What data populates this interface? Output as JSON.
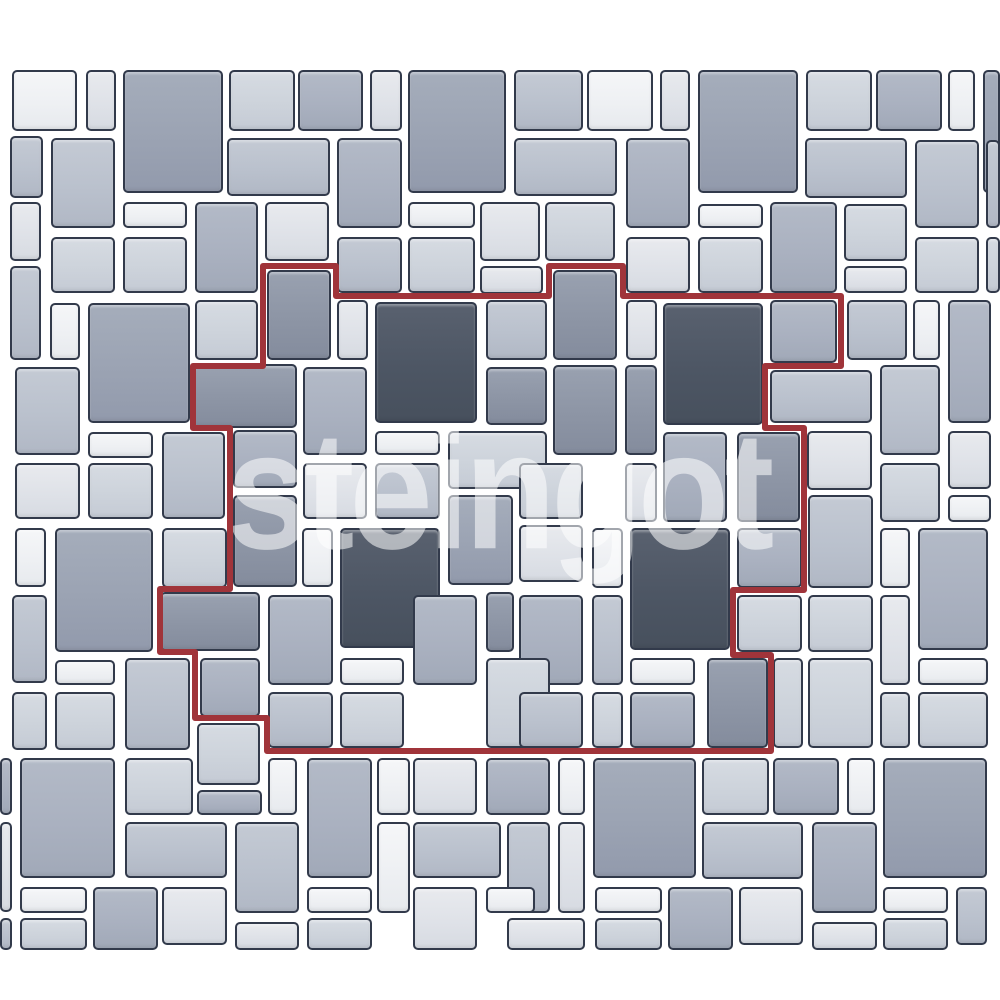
{
  "canvas": {
    "width": 1000,
    "height": 1000,
    "background": "#ffffff"
  },
  "watermark": {
    "text": "steingot",
    "color": "rgba(255,255,255,0.55)"
  },
  "module_outline": {
    "color": "#a0343a",
    "stroke_width": 6,
    "path": "M263,266 H336 V296 H549 V266 H623 V296 H841 V366 H765 V428 H804 V590 H733 V655 H771 V751 H267 V718 H195 V652 H160 V589 H230 V428 H193 V366 H263 Z"
  },
  "palette": {
    "c0": {
      "top": "#f5f6f8",
      "base": "#eef0f3",
      "bottom": "#e7eaee"
    },
    "c1": {
      "top": "#e8eaee",
      "base": "#dfe2e8",
      "bottom": "#d7dbe2"
    },
    "c2": {
      "top": "#d6dbe2",
      "base": "#cdd3db",
      "bottom": "#c5cbd5"
    },
    "c3": {
      "top": "#c4cad4",
      "base": "#bac1cd",
      "bottom": "#b1b8c5"
    },
    "c4": {
      "top": "#b3bac7",
      "base": "#aab1c0",
      "bottom": "#a1a9b8"
    },
    "c5": {
      "top": "#a5adbb",
      "base": "#9ba3b3",
      "bottom": "#929aac"
    },
    "c6": {
      "top": "#99a1b0",
      "base": "#8d95a5",
      "bottom": "#848c9d"
    },
    "c7": {
      "top": "#59616f",
      "base": "#4d5664",
      "bottom": "#47505d"
    }
  },
  "tile_border_color": "#323a4b",
  "tiles": [
    [
      12,
      70,
      65,
      61,
      "c0"
    ],
    [
      86,
      70,
      30,
      61,
      "c1"
    ],
    [
      123,
      70,
      100,
      123,
      "c5"
    ],
    [
      229,
      70,
      66,
      61,
      "c2"
    ],
    [
      298,
      70,
      65,
      61,
      "c4"
    ],
    [
      370,
      70,
      32,
      61,
      "c1"
    ],
    [
      408,
      70,
      98,
      123,
      "c5"
    ],
    [
      514,
      70,
      69,
      61,
      "c3"
    ],
    [
      587,
      70,
      66,
      61,
      "c0"
    ],
    [
      660,
      70,
      30,
      61,
      "c1"
    ],
    [
      698,
      70,
      100,
      123,
      "c5"
    ],
    [
      806,
      70,
      66,
      61,
      "c2"
    ],
    [
      876,
      70,
      66,
      61,
      "c4"
    ],
    [
      948,
      70,
      27,
      61,
      "c0"
    ],
    [
      983,
      70,
      17,
      123,
      "c5"
    ],
    [
      10,
      136,
      33,
      62,
      "c3"
    ],
    [
      51,
      138,
      64,
      90,
      "c3"
    ],
    [
      227,
      138,
      103,
      58,
      "c3"
    ],
    [
      337,
      138,
      65,
      90,
      "c4"
    ],
    [
      514,
      138,
      103,
      58,
      "c3"
    ],
    [
      626,
      138,
      64,
      90,
      "c4"
    ],
    [
      805,
      138,
      102,
      60,
      "c3"
    ],
    [
      915,
      140,
      64,
      88,
      "c3"
    ],
    [
      986,
      140,
      14,
      88,
      "c3"
    ],
    [
      10,
      202,
      31,
      59,
      "c1"
    ],
    [
      123,
      202,
      64,
      26,
      "c0"
    ],
    [
      195,
      202,
      63,
      91,
      "c4"
    ],
    [
      265,
      202,
      64,
      59,
      "c1"
    ],
    [
      408,
      202,
      67,
      26,
      "c0"
    ],
    [
      480,
      202,
      60,
      59,
      "c1"
    ],
    [
      545,
      202,
      70,
      59,
      "c2"
    ],
    [
      698,
      204,
      65,
      24,
      "c0"
    ],
    [
      770,
      202,
      67,
      91,
      "c4"
    ],
    [
      844,
      204,
      63,
      57,
      "c2"
    ],
    [
      51,
      237,
      64,
      56,
      "c2"
    ],
    [
      123,
      237,
      64,
      56,
      "c2"
    ],
    [
      337,
      237,
      65,
      56,
      "c3"
    ],
    [
      408,
      237,
      67,
      56,
      "c2"
    ],
    [
      626,
      237,
      64,
      56,
      "c1"
    ],
    [
      698,
      237,
      65,
      56,
      "c2"
    ],
    [
      915,
      237,
      64,
      56,
      "c2"
    ],
    [
      986,
      237,
      14,
      56,
      "c2"
    ],
    [
      844,
      266,
      63,
      27,
      "c1"
    ],
    [
      480,
      266,
      63,
      28,
      "c1"
    ],
    [
      10,
      266,
      31,
      94,
      "c3"
    ],
    [
      267,
      270,
      64,
      90,
      "c6"
    ],
    [
      553,
      270,
      64,
      90,
      "c6"
    ],
    [
      50,
      303,
      30,
      57,
      "c0"
    ],
    [
      88,
      303,
      102,
      120,
      "c5"
    ],
    [
      195,
      300,
      63,
      60,
      "c2"
    ],
    [
      337,
      300,
      31,
      60,
      "c1"
    ],
    [
      375,
      302,
      102,
      121,
      "c7"
    ],
    [
      486,
      300,
      61,
      60,
      "c3"
    ],
    [
      626,
      300,
      31,
      60,
      "c1"
    ],
    [
      663,
      303,
      100,
      122,
      "c7"
    ],
    [
      770,
      300,
      67,
      63,
      "c4"
    ],
    [
      847,
      300,
      60,
      60,
      "c3"
    ],
    [
      913,
      300,
      27,
      60,
      "c0"
    ],
    [
      948,
      300,
      43,
      123,
      "c4"
    ],
    [
      15,
      367,
      65,
      88,
      "c3"
    ],
    [
      193,
      364,
      104,
      64,
      "c6"
    ],
    [
      303,
      367,
      64,
      88,
      "c4"
    ],
    [
      486,
      367,
      61,
      58,
      "c6"
    ],
    [
      553,
      365,
      64,
      90,
      "c6"
    ],
    [
      625,
      365,
      32,
      90,
      "c6"
    ],
    [
      770,
      370,
      102,
      53,
      "c3"
    ],
    [
      880,
      365,
      60,
      90,
      "c3"
    ],
    [
      88,
      432,
      65,
      26,
      "c0"
    ],
    [
      162,
      432,
      63,
      87,
      "c3"
    ],
    [
      233,
      430,
      64,
      58,
      "c4"
    ],
    [
      375,
      431,
      65,
      24,
      "c0"
    ],
    [
      448,
      431,
      99,
      58,
      "c2"
    ],
    [
      663,
      432,
      64,
      90,
      "c4"
    ],
    [
      737,
      432,
      63,
      90,
      "c6"
    ],
    [
      807,
      431,
      65,
      59,
      "c1"
    ],
    [
      948,
      431,
      43,
      58,
      "c1"
    ],
    [
      15,
      463,
      65,
      56,
      "c1"
    ],
    [
      88,
      463,
      65,
      56,
      "c2"
    ],
    [
      303,
      463,
      64,
      56,
      "c1"
    ],
    [
      375,
      463,
      65,
      56,
      "c3"
    ],
    [
      519,
      463,
      64,
      56,
      "c2"
    ],
    [
      625,
      463,
      32,
      59,
      "c1"
    ],
    [
      880,
      463,
      60,
      59,
      "c2"
    ],
    [
      948,
      495,
      43,
      27,
      "c0"
    ],
    [
      233,
      495,
      64,
      92,
      "c6"
    ],
    [
      448,
      495,
      65,
      90,
      "c5"
    ],
    [
      808,
      495,
      65,
      93,
      "c3"
    ],
    [
      15,
      528,
      31,
      59,
      "c0"
    ],
    [
      55,
      528,
      98,
      124,
      "c5"
    ],
    [
      162,
      528,
      65,
      60,
      "c2"
    ],
    [
      302,
      528,
      31,
      59,
      "c0"
    ],
    [
      340,
      528,
      100,
      120,
      "c7"
    ],
    [
      519,
      525,
      64,
      57,
      "c1"
    ],
    [
      592,
      528,
      31,
      60,
      "c0"
    ],
    [
      630,
      528,
      100,
      122,
      "c7"
    ],
    [
      737,
      528,
      65,
      60,
      "c4"
    ],
    [
      880,
      528,
      30,
      60,
      "c0"
    ],
    [
      918,
      528,
      70,
      122,
      "c4"
    ],
    [
      12,
      595,
      35,
      88,
      "c3"
    ],
    [
      160,
      592,
      100,
      59,
      "c6"
    ],
    [
      268,
      595,
      65,
      90,
      "c4"
    ],
    [
      413,
      595,
      64,
      90,
      "c4"
    ],
    [
      486,
      592,
      28,
      60,
      "c6"
    ],
    [
      519,
      595,
      64,
      90,
      "c4"
    ],
    [
      592,
      595,
      31,
      90,
      "c3"
    ],
    [
      737,
      595,
      65,
      57,
      "c2"
    ],
    [
      808,
      595,
      65,
      57,
      "c2"
    ],
    [
      880,
      595,
      30,
      90,
      "c1"
    ],
    [
      55,
      660,
      60,
      25,
      "c0"
    ],
    [
      125,
      658,
      65,
      92,
      "c3"
    ],
    [
      200,
      658,
      60,
      59,
      "c4"
    ],
    [
      340,
      658,
      64,
      27,
      "c0"
    ],
    [
      486,
      658,
      64,
      90,
      "c2"
    ],
    [
      630,
      658,
      65,
      27,
      "c0"
    ],
    [
      707,
      658,
      61,
      90,
      "c6"
    ],
    [
      773,
      658,
      30,
      90,
      "c2"
    ],
    [
      808,
      658,
      65,
      90,
      "c2"
    ],
    [
      918,
      658,
      70,
      27,
      "c0"
    ],
    [
      12,
      692,
      35,
      58,
      "c2"
    ],
    [
      55,
      692,
      60,
      58,
      "c2"
    ],
    [
      268,
      692,
      65,
      56,
      "c3"
    ],
    [
      340,
      692,
      64,
      56,
      "c2"
    ],
    [
      519,
      692,
      64,
      56,
      "c3"
    ],
    [
      592,
      692,
      31,
      56,
      "c2"
    ],
    [
      630,
      692,
      65,
      56,
      "c4"
    ],
    [
      880,
      692,
      30,
      56,
      "c2"
    ],
    [
      918,
      692,
      70,
      56,
      "c2"
    ],
    [
      197,
      723,
      63,
      62,
      "c2"
    ],
    [
      0,
      758,
      12,
      57,
      "c4"
    ],
    [
      20,
      758,
      95,
      120,
      "c4"
    ],
    [
      125,
      758,
      68,
      57,
      "c2"
    ],
    [
      197,
      790,
      65,
      25,
      "c4"
    ],
    [
      268,
      758,
      29,
      57,
      "c0"
    ],
    [
      307,
      758,
      65,
      120,
      "c4"
    ],
    [
      377,
      758,
      33,
      57,
      "c0"
    ],
    [
      413,
      758,
      64,
      57,
      "c1"
    ],
    [
      486,
      758,
      64,
      57,
      "c4"
    ],
    [
      558,
      758,
      27,
      57,
      "c0"
    ],
    [
      593,
      758,
      103,
      120,
      "c5"
    ],
    [
      702,
      758,
      67,
      57,
      "c2"
    ],
    [
      773,
      758,
      66,
      57,
      "c4"
    ],
    [
      847,
      758,
      28,
      57,
      "c0"
    ],
    [
      883,
      758,
      104,
      120,
      "c5"
    ],
    [
      0,
      822,
      12,
      90,
      "c1"
    ],
    [
      125,
      822,
      102,
      56,
      "c3"
    ],
    [
      235,
      822,
      64,
      91,
      "c3"
    ],
    [
      377,
      822,
      33,
      91,
      "c0"
    ],
    [
      413,
      822,
      88,
      56,
      "c3"
    ],
    [
      507,
      822,
      43,
      91,
      "c3"
    ],
    [
      558,
      822,
      27,
      91,
      "c1"
    ],
    [
      702,
      822,
      101,
      57,
      "c3"
    ],
    [
      812,
      822,
      65,
      91,
      "c4"
    ],
    [
      20,
      887,
      67,
      26,
      "c0"
    ],
    [
      93,
      887,
      65,
      63,
      "c4"
    ],
    [
      162,
      887,
      65,
      58,
      "c1"
    ],
    [
      235,
      922,
      64,
      28,
      "c1"
    ],
    [
      307,
      887,
      65,
      26,
      "c0"
    ],
    [
      413,
      887,
      64,
      63,
      "c1"
    ],
    [
      486,
      887,
      49,
      26,
      "c0"
    ],
    [
      595,
      887,
      67,
      26,
      "c0"
    ],
    [
      668,
      887,
      65,
      63,
      "c4"
    ],
    [
      739,
      887,
      64,
      58,
      "c1"
    ],
    [
      883,
      887,
      65,
      26,
      "c0"
    ],
    [
      956,
      887,
      31,
      58,
      "c3"
    ],
    [
      0,
      918,
      12,
      32,
      "c3"
    ],
    [
      20,
      918,
      67,
      32,
      "c2"
    ],
    [
      307,
      918,
      65,
      32,
      "c2"
    ],
    [
      507,
      918,
      78,
      32,
      "c1"
    ],
    [
      595,
      918,
      67,
      32,
      "c2"
    ],
    [
      812,
      922,
      65,
      28,
      "c1"
    ],
    [
      883,
      918,
      65,
      32,
      "c2"
    ]
  ]
}
